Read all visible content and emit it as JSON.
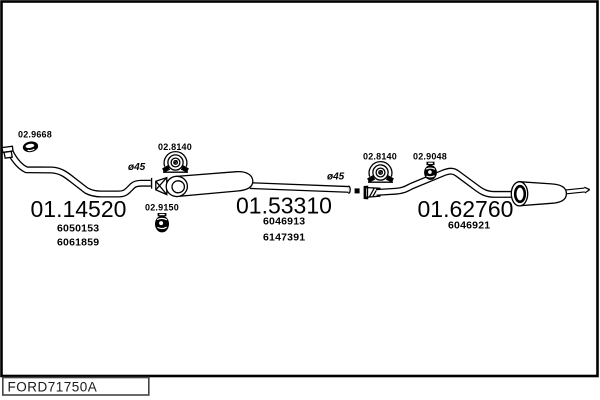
{
  "diagram": {
    "background": "#ffffff",
    "line_color": "#000000",
    "code_box": {
      "code": "FORD71750A"
    },
    "labels": {
      "gasket": "02.9668",
      "clamp_front": "02.8140",
      "hanger_middle": "02.9150",
      "diameter_front": "ø45",
      "diameter_rear": "ø45",
      "clamp_rear": "02.8140",
      "hanger_rear": "02.9048"
    },
    "sections": {
      "front_pipe": {
        "part_number": "01.14520",
        "oe_refs": [
          "6050153",
          "6061859"
        ]
      },
      "middle_silencer": {
        "part_number": "01.53310",
        "oe_refs": [
          "6046913",
          "6147391"
        ]
      },
      "rear_silencer": {
        "part_number": "01.62760",
        "oe_refs": [
          "6046921"
        ]
      }
    },
    "icons": {
      "gasket_icon": "exhaust-gasket-ring",
      "clamp_icon": "pipe-mounting-clamp",
      "rubber_hanger_icon": "rubber-mounting-ring",
      "strap_hanger_icon": "rubber-strap-hanger",
      "flange_icon": "manifold-flange"
    }
  }
}
